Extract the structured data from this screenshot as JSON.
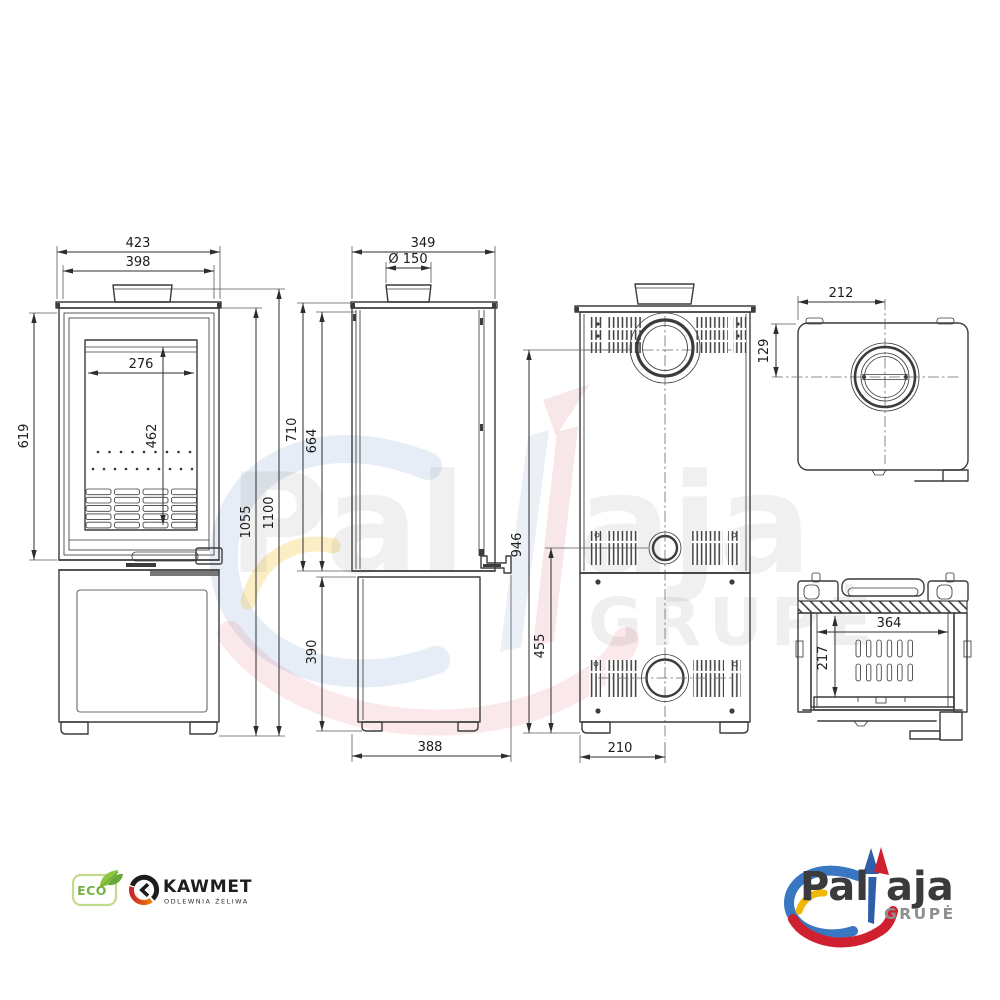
{
  "dims": {
    "front": {
      "overall_width": "423",
      "body_width": "398",
      "glass_width": "276",
      "glass_height": "462",
      "firebox_section_height": "619",
      "body_height": "1055",
      "total_height": "1100"
    },
    "side": {
      "depth": "349",
      "flue_diameter": "Ø 150",
      "upper_height": "710",
      "door_side_height": "664",
      "base_height": "390",
      "base_depth": "388"
    },
    "back": {
      "flue_axis_height": "946",
      "rear_outlet_height": "455",
      "base_center_offset": "210"
    },
    "top": {
      "flue_center_from_edge": "212",
      "flue_center_from_back": "129"
    },
    "firebox": {
      "interior_width": "364",
      "interior_depth": "217"
    }
  },
  "watermark": {
    "word_left": "Pal",
    "word_right": "aja",
    "subtitle": "GRUPĖ"
  },
  "branding": {
    "eco_label": "ECO",
    "kawmet_name": "KAWMET",
    "kawmet_subtitle": "ODLEWNIA ŻELIWA",
    "palaja_left": "Pal",
    "palaja_right": "aja",
    "palaja_subtitle": "GRUPĖ"
  },
  "colors": {
    "line": "#3c3c3c",
    "dimension_text": "#1c1c1c",
    "eco_green": "#76b043",
    "kawmet_black": "#1d1d1b",
    "kawmet_red": "#c9252c",
    "kawmet_orange": "#ef7c00",
    "palaja_blue": "#2f6db5",
    "palaja_red": "#cf2030",
    "palaja_yellow": "#f2b705",
    "palaja_text": "#3b3b3d",
    "palaja_gray": "#8f8f8f"
  }
}
